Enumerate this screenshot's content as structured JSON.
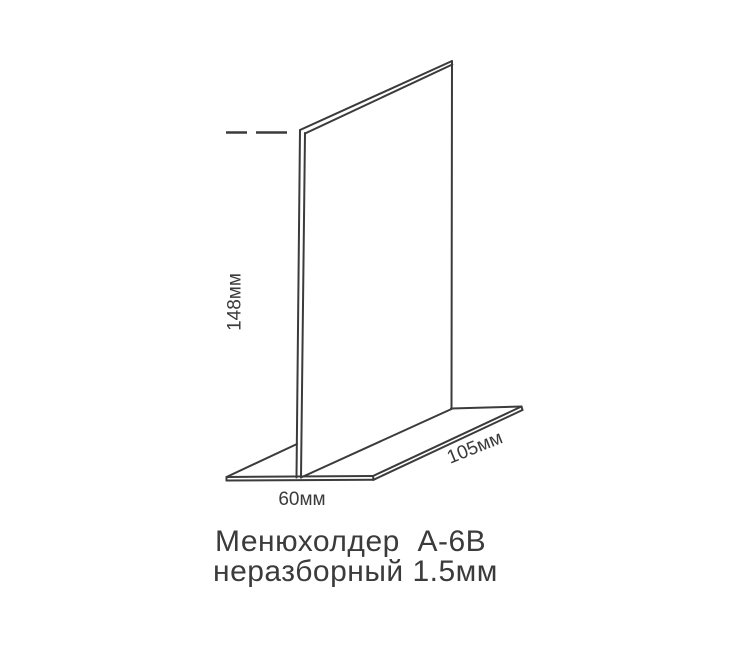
{
  "page": {
    "background_color": "#ffffff"
  },
  "diagram": {
    "kind": "product-dimension-drawing",
    "product": "menu-holder-t-stand",
    "line_color": "#3b3b3b",
    "text_color": "#3b3b3b",
    "dimensions": {
      "height": "148мм",
      "depth": "60мм",
      "length": "105мм"
    },
    "title_line1": "Менюхолдер  А-6В",
    "title_line2": "неразборный 1.5мм"
  }
}
